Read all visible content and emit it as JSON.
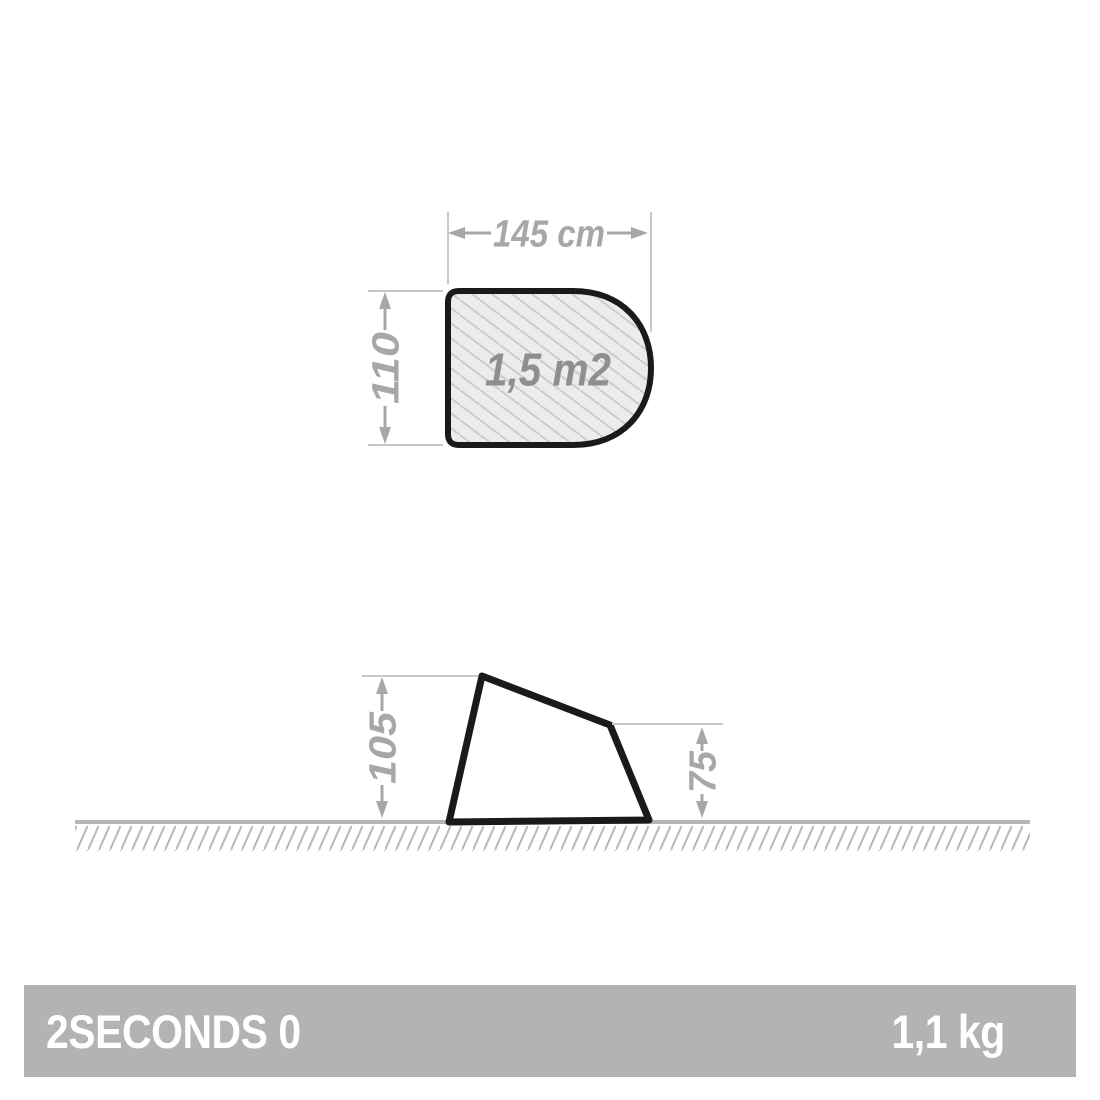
{
  "product": {
    "name": "2SECONDS 0",
    "weight": "1,1 kg"
  },
  "top_view": {
    "width": "145 cm",
    "depth": "110",
    "area": "1,5 m2"
  },
  "side_view": {
    "front_height": "105",
    "rear_height": "75"
  },
  "colors": {
    "outline_black": "#1a1a1a",
    "dimension_gray": "#a7a7a7",
    "extension_line_gray": "#c9c9c9",
    "floor_fill": "#ececec",
    "floor_hatch": "#cccccc",
    "ground_line": "#b5b5b5",
    "ground_hatch": "#b8b8b8",
    "footer_bar": "#b3b3b3",
    "footer_text": "#ffffff"
  }
}
